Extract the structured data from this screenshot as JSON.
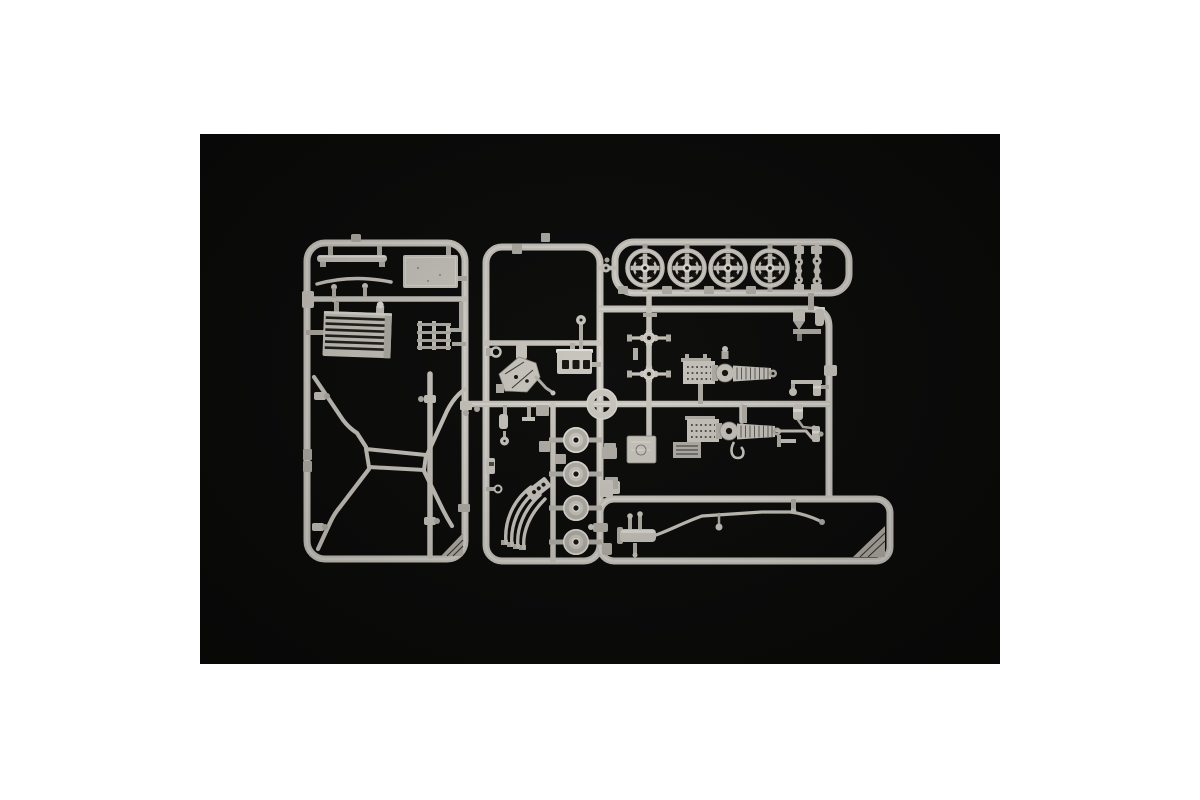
{
  "page": {
    "background": "#ffffff"
  },
  "photo": {
    "background": "#0a0a09",
    "subject": "Injection-molded model kit sprue of light grey plastic car parts photographed on a black background",
    "colors": {
      "plastic": "#c9c6be",
      "plastic_light": "#e4e2db",
      "plastic_mid": "#b2afa7",
      "plastic_dark": "#8b887f",
      "hole": "#15140f"
    }
  },
  "sprue": {
    "frames": [
      {
        "id": "left",
        "label": "left runner frame"
      },
      {
        "id": "center",
        "label": "center runner frame"
      },
      {
        "id": "wheels",
        "label": "top-right wheels runner frame"
      },
      {
        "id": "right",
        "label": "right runner section"
      },
      {
        "id": "bottom",
        "label": "bottom-right runner frame"
      }
    ],
    "parts": [
      {
        "name": "spoked wheel rim",
        "count": 4
      },
      {
        "name": "brake drum",
        "count": 4
      },
      {
        "name": "radiator grille",
        "count": 1
      },
      {
        "name": "chassis cross frame",
        "count": 1
      },
      {
        "name": "exhaust manifold",
        "count": 1
      },
      {
        "name": "supercharger axle assembly",
        "count": 2
      },
      {
        "name": "anti-roll bar",
        "count": 1
      },
      {
        "name": "engine block",
        "count": 1
      },
      {
        "name": "steering ring",
        "count": 1
      },
      {
        "name": "universal joint",
        "count": 2
      },
      {
        "name": "flat plate",
        "count": 2
      },
      {
        "name": "small fittings and molding tabs"
      }
    ]
  }
}
